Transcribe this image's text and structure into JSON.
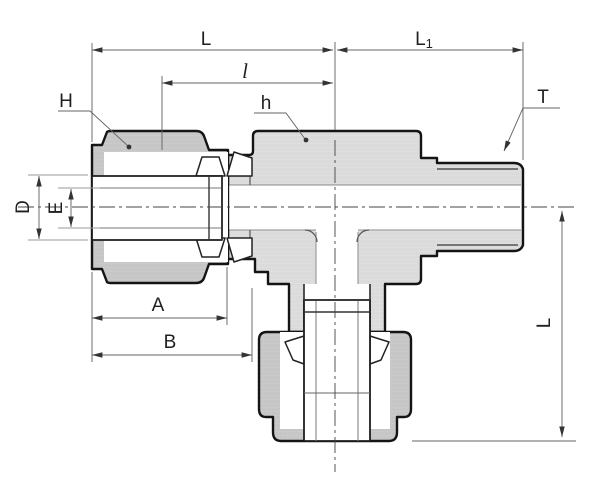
{
  "diagram": {
    "type": "technical-drawing-cross-section",
    "subject": "branch tee tube fitting with compression nuts and male thread",
    "labels": {
      "L_run": "L",
      "L1_base": "L",
      "L1_sub": "1",
      "l_small": "l",
      "H_nut": "H",
      "h_body": "h",
      "T_thread": "T",
      "D_tube_od": "D",
      "E_bore": "E",
      "A_dim": "A",
      "B_dim": "B",
      "L_drop": "L"
    },
    "colors": {
      "background": "#ffffff",
      "outline": "#141414",
      "body_fill": "#e0e0e0",
      "nut_fill": "#cccccc",
      "dimension_line": "#666666",
      "centerline": "#444444",
      "label_text": "#1f1f1f"
    }
  }
}
